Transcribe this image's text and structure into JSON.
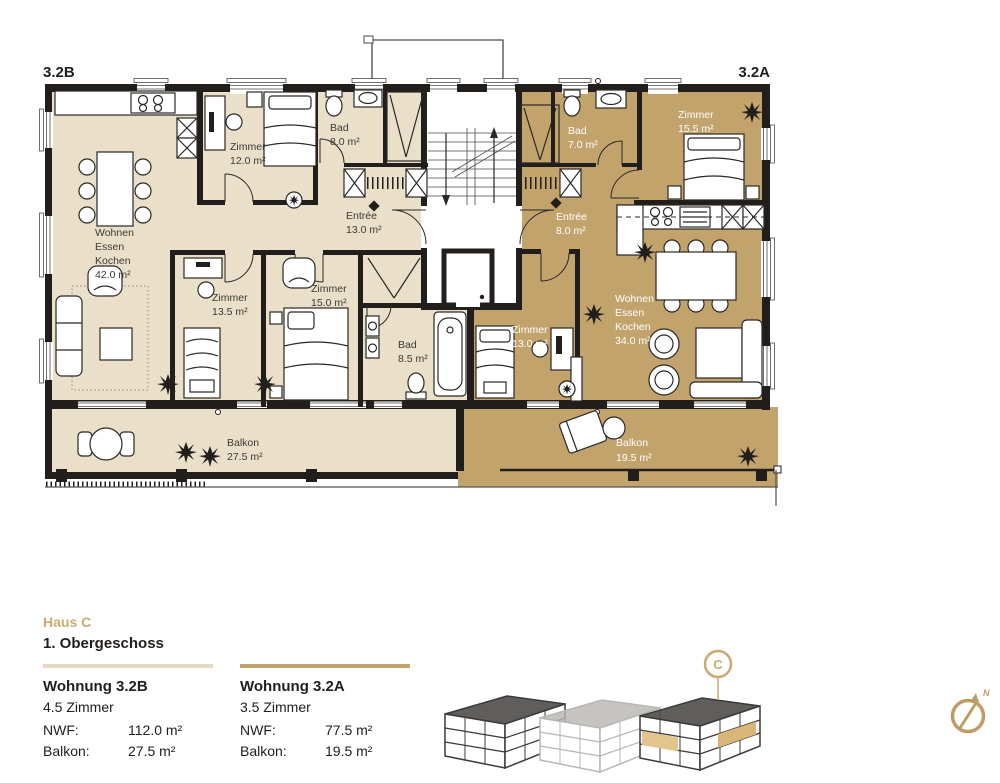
{
  "plan": {
    "unit_b_tag": "3.2B",
    "unit_a_tag": "3.2A",
    "labels": {
      "wek_b": {
        "l1": "Wohnen",
        "l2": "Essen",
        "l3": "Kochen",
        "area": "42.0 m²"
      },
      "zimmer12": {
        "name": "Zimmer",
        "area": "12.0 m²"
      },
      "bad8": {
        "name": "Bad",
        "area": "8.0 m²"
      },
      "entree13": {
        "name": "Entrée",
        "area": "13.0 m²"
      },
      "zimmer135": {
        "name": "Zimmer",
        "area": "13.5 m²"
      },
      "zimmer15": {
        "name": "Zimmer",
        "area": "15.0 m²"
      },
      "bad85": {
        "name": "Bad",
        "area": "8.5 m²"
      },
      "balkon_b": {
        "name": "Balkon",
        "area": "27.5 m²"
      },
      "bad7": {
        "name": "Bad",
        "area": "7.0 m²"
      },
      "entree8": {
        "name": "Entrée",
        "area": "8.0 m²"
      },
      "zimmer155": {
        "name": "Zimmer",
        "area": "15.5 m²"
      },
      "wek_a": {
        "l1": "Wohnen",
        "l2": "Essen",
        "l3": "Kochen",
        "area": "34.0 m²"
      },
      "zimmer13": {
        "name": "Zimmer",
        "area": "13.0 m²"
      },
      "balkon_a": {
        "name": "Balkon",
        "area": "19.5 m²"
      }
    }
  },
  "footer": {
    "house": "Haus C",
    "floor": "1. Obergeschoss",
    "units": [
      {
        "name": "Wohnung 3.2B",
        "rooms": "4.5 Zimmer",
        "nwf_label": "NWF:",
        "nwf": "112.0 m²",
        "balkon_label": "Balkon:",
        "balkon": "27.5 m²"
      },
      {
        "name": "Wohnung 3.2A",
        "rooms": "3.5 Zimmer",
        "nwf_label": "NWF:",
        "nwf": "77.5 m²",
        "balkon_label": "Balkon:",
        "balkon": "19.5 m²"
      }
    ],
    "marker": "C",
    "compass_n": "N"
  },
  "colors": {
    "unit_b_fill": "#eadfc9",
    "unit_a_fill": "#c2a36c",
    "wall": "#211e1c",
    "accent": "#c9aa72",
    "divider_b": "#e5dbc2",
    "divider_a": "#c2a36c"
  }
}
